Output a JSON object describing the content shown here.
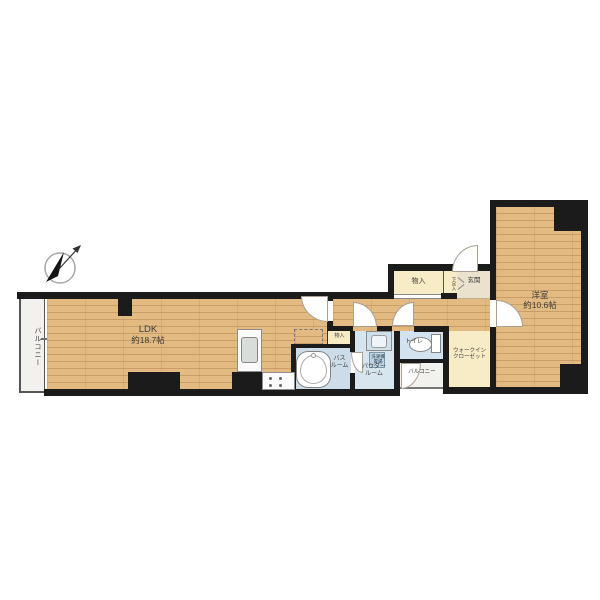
{
  "rooms": {
    "ldk": {
      "name": "LDK",
      "size": "約18.7帖"
    },
    "western_room": {
      "name": "洋室",
      "size": "約10.6帖"
    },
    "balcony_left": {
      "name": "バルコニー"
    },
    "balcony_small": {
      "name": "バルコニー"
    },
    "entrance": {
      "name": "玄関"
    },
    "shoe_box": {
      "name": "下足入"
    },
    "storage_top": {
      "name": "物入"
    },
    "storage_small": {
      "name": "物入"
    },
    "toilet": {
      "name": "トイレ"
    },
    "bath": {
      "line1": "バス",
      "line2": "ルーム"
    },
    "powder": {
      "line1": "パウダー",
      "line2": "ルーム"
    },
    "walk_in_closet": {
      "line1": "ウォークイン",
      "line2": "クローゼット"
    },
    "laundry": {
      "line1": "洗濯機",
      "line2": "置場"
    }
  },
  "icons": {
    "compass": "north-arrow-compass"
  },
  "palette": {
    "wood": "#e3ba82",
    "wood_line": "#c79e68",
    "closet_cream": "#f7ecc5",
    "wet_area_blue": "#d2e2ee",
    "wall_black": "#1b1b1b",
    "balcony_gray": "#f2f1ed"
  }
}
